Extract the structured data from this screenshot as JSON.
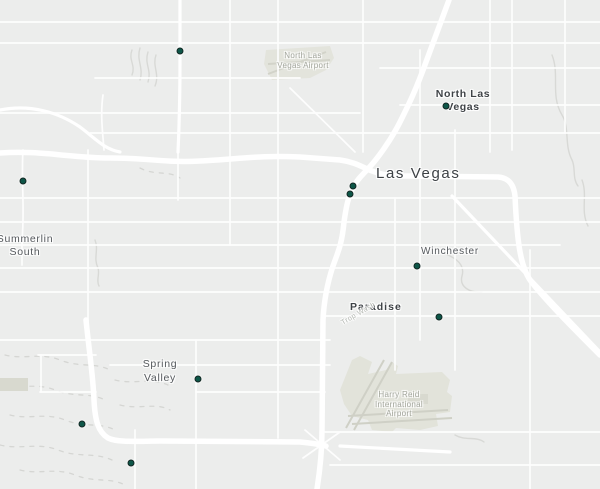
{
  "map": {
    "colors": {
      "background": "#ecedec",
      "road": "#ffffff",
      "airport_fill": "#e2e3da",
      "runway": "#cfd0c6",
      "wash_line": "#d8d9d6",
      "marker_fill": "#0e5648",
      "marker_ring": "#132824",
      "city_label": "#3d4145",
      "town_label": "#54585c",
      "airport_label": "#a2a59b"
    },
    "places": {
      "las_vegas": {
        "name": "Las Vegas"
      },
      "north_las_vegas": {
        "line1": "North Las",
        "line2": "Vegas"
      },
      "summerlin_south": {
        "line1": "Summerlin",
        "line2": "South"
      },
      "winchester": {
        "name": "Winchester"
      },
      "paradise": {
        "name": "Paradise"
      },
      "spring_valley": {
        "line1": "Spring",
        "line2": "Valley"
      },
      "north_las_vegas_airport": {
        "line1": "North Las",
        "line2": "Vegas Airport"
      },
      "harry_reid_airport": {
        "line1": "Harry Reid",
        "line2": "International",
        "line3": "Airport"
      },
      "trop_wash": {
        "name": "Trop Wash"
      }
    },
    "markers": [
      {
        "x": 180,
        "y": 51
      },
      {
        "x": 446,
        "y": 106
      },
      {
        "x": 23,
        "y": 181
      },
      {
        "x": 353,
        "y": 186
      },
      {
        "x": 350,
        "y": 194
      },
      {
        "x": 417,
        "y": 266
      },
      {
        "x": 439,
        "y": 317
      },
      {
        "x": 198,
        "y": 379
      },
      {
        "x": 82,
        "y": 424
      },
      {
        "x": 131,
        "y": 463
      }
    ]
  }
}
